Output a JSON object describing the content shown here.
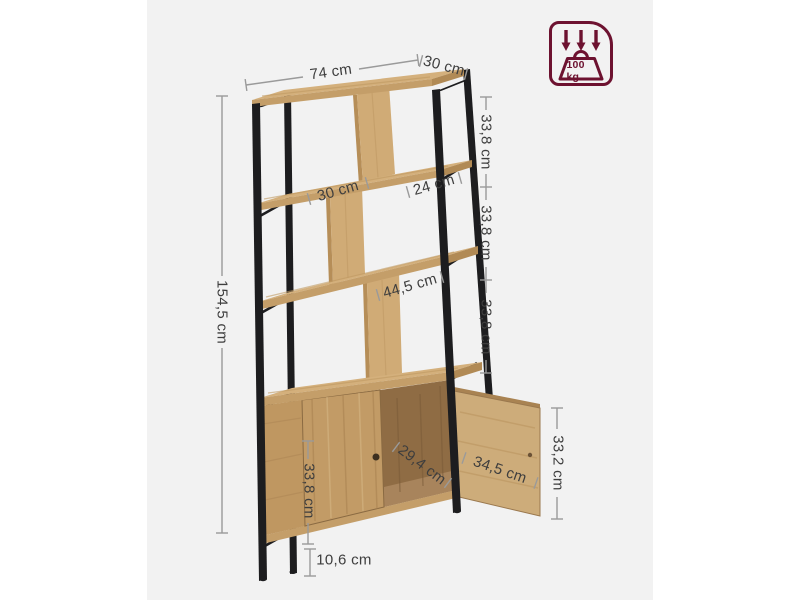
{
  "page": {
    "background": "#ffffff",
    "panel_color": "#f2f2f2"
  },
  "load_badge": {
    "label": "100 kg",
    "accent_color": "#6d1230",
    "icon": "max-load-weight-icon"
  },
  "illustration": {
    "frame_color": "#1d1d1f",
    "wood_color": "#cdab79",
    "dimension_line_color": "#9a9a9a",
    "label_color": "#3e3e3e"
  },
  "dimensions": {
    "total_width": "74 cm",
    "total_depth": "30 cm",
    "total_height": "154,5 cm",
    "shelf_gap_1": "33,8 cm",
    "shelf_gap_2": "33,8 cm",
    "shelf_gap_3": "33,8 cm",
    "cubby_left_width": "30 cm",
    "cubby_right_width": "24 cm",
    "cubby_wide_width": "44,5 cm",
    "cabinet_door_height": "33,8 cm",
    "cabinet_interior_depth": "29,4 cm",
    "cabinet_door_width": "34,5 cm",
    "open_door_height": "33,2 cm",
    "leg_clearance_height": "10,6 cm"
  }
}
